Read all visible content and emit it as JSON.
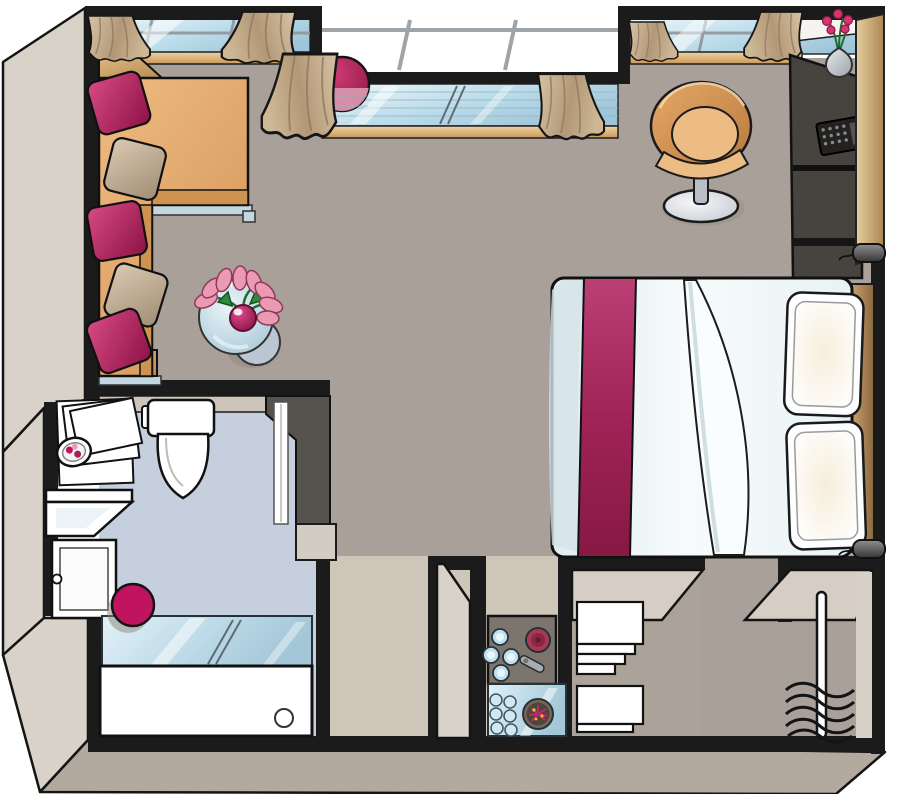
{
  "meta": {
    "kind": "floor-plan-illustration",
    "view": "top-down-3d-cutaway",
    "text_content": "none"
  },
  "palette": {
    "background": "#ffffff",
    "wall": "#1b1b1b",
    "floor_main": "#a9a199",
    "floor_bath": "#c6cfdd",
    "floor_kitchen": "#cfc6ba",
    "face_light": "#d8d2c9",
    "face_dark": "#b3a99e",
    "inner_beige": "#cdc4ba",
    "dark_wall": "#56524d",
    "desk_dark": "#47433e",
    "glass_high": "#e8f4f8",
    "glass_low": "#a6cad9",
    "sill": "#d9a96b",
    "curtain": "#c2a988",
    "sofa": "#e2a763",
    "sofa_dark": "#cf9351",
    "wood": "#c9a369",
    "magenta": "#b02358",
    "magenta_soft": "#d893ad",
    "pillow_beige": "#c9b7a1",
    "duvet": "#eef5f7",
    "metal": "#c2d7e0",
    "chair": "#d8965a",
    "chair_seat": "#ecbc84",
    "stool": "#c0155e",
    "counter": "#7b756d",
    "hotplate": "#a83a54",
    "glassware": "#bfe0ee",
    "bowl_dark": "#4e463c",
    "towel": "#ffffff",
    "door": "#d3b079",
    "headboard": "#bf9a64",
    "lamp": "#5a5a5a",
    "flower_pink": "#d6356f",
    "leaf_green": "#2e8b3e",
    "white_fixture": "#ffffff"
  },
  "objects": {
    "living_area": [
      "l-shaped-sofa",
      "magenta-pillows",
      "beige-pillows",
      "round-glass-coffee-table",
      "tulip-bouquet-in-vase",
      "balcony-pouf",
      "tub-chair",
      "wall-desk-unit",
      "laptop",
      "flower-vase",
      "entrance-door"
    ],
    "sleeping_area": [
      "double-bed",
      "magenta-bed-runner",
      "duvet-fold",
      "two-pillows",
      "headboard",
      "reading-lamps"
    ],
    "bathroom": [
      "toilet",
      "vanity-shelves",
      "soap-dish",
      "washbasin",
      "storage-cabinet",
      "magenta-stool",
      "glass-shower-screen",
      "bathtub",
      "sliding-door"
    ],
    "kitchenette": [
      "counter",
      "drinking-glasses",
      "hotplate",
      "bottle-opener",
      "glass-shelf",
      "small-glasses",
      "flower-bowl"
    ],
    "storage": [
      "towel-shelves",
      "wardrobe-shelf",
      "clothes-rail",
      "hangers"
    ]
  },
  "windows": {
    "count": 3,
    "features": [
      "curtain-pairs",
      "recessed-balcony-bay",
      "glass-sliding-panels"
    ]
  }
}
